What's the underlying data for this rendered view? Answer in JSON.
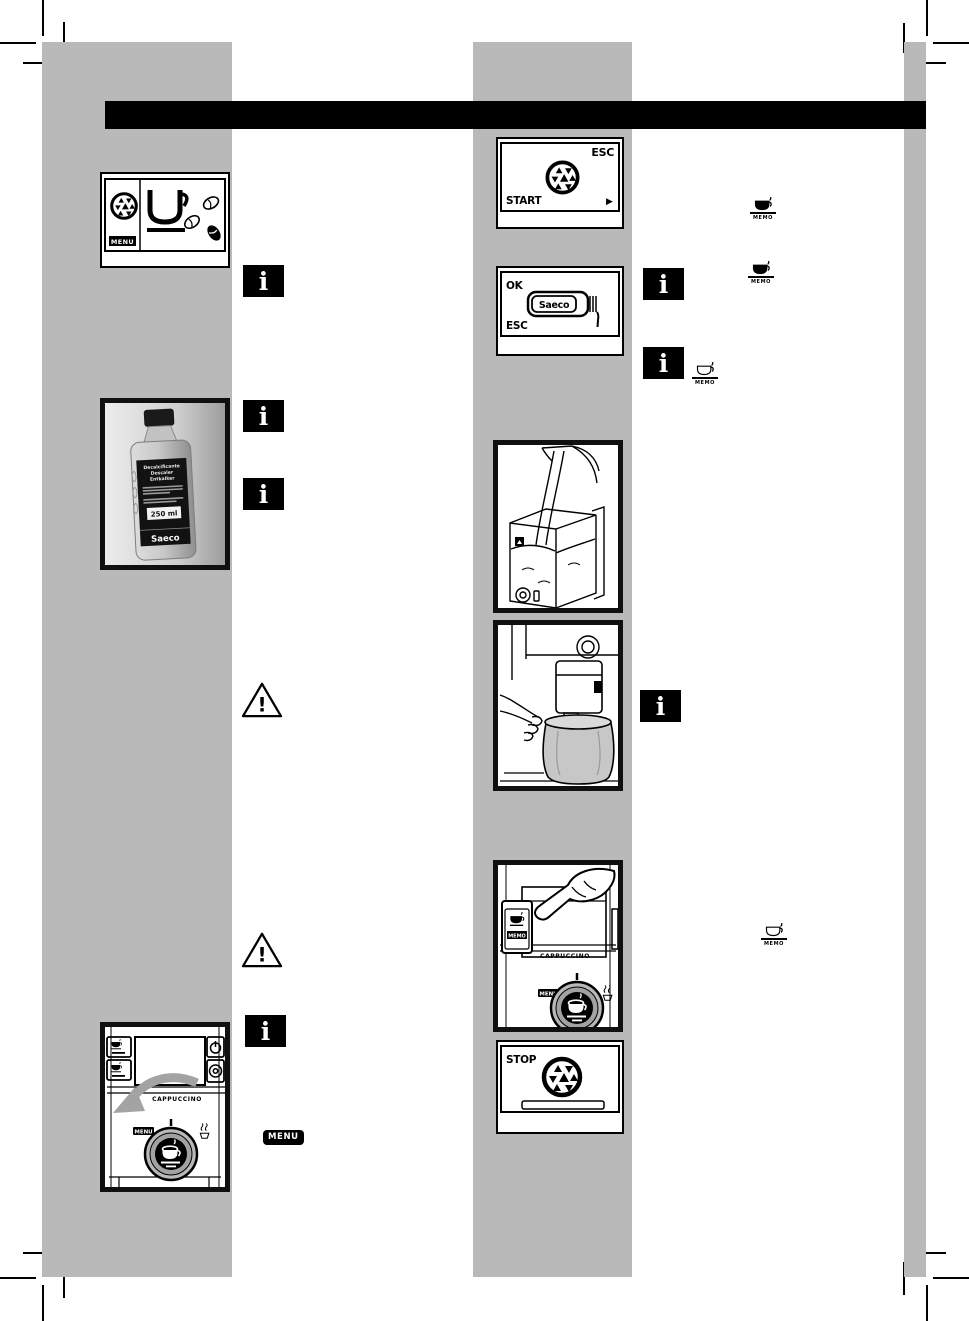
{
  "page": {
    "background": "#ffffff",
    "column_gray": "#b9b9b9",
    "header_bar_color": "#000000",
    "ink": "#000000"
  },
  "labels": {
    "info": "i",
    "warning": "!",
    "memo": "MEMO",
    "menu": "MENU",
    "cappuccino": "CAPPUCCINO",
    "esc": "ESC",
    "start": "START",
    "ok": "OK",
    "stop": "STOP",
    "arrow_right": "▶",
    "saeco": "Saeco"
  },
  "bottle": {
    "label_line1": "Decalcificante",
    "label_line2": "Descaler",
    "label_line3": "Entkalker",
    "volume": "250 ml",
    "brand": "Saeco"
  }
}
